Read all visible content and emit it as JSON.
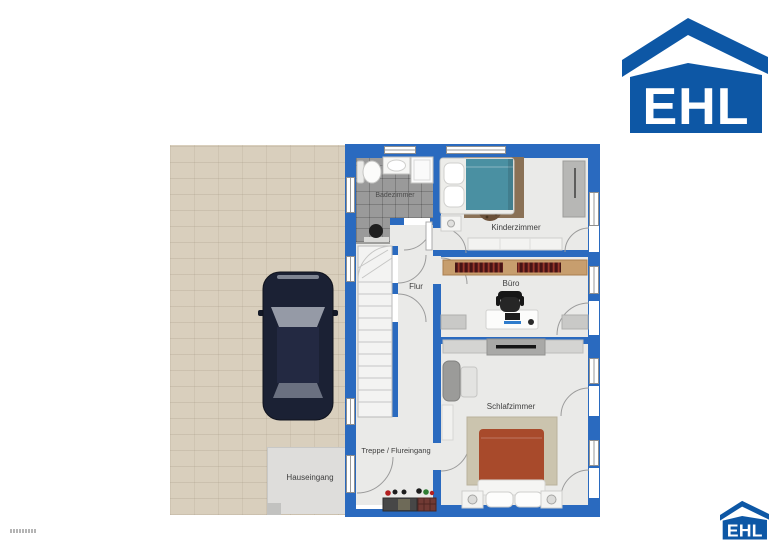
{
  "logo": {
    "text": "EHL"
  },
  "plan": {
    "rooms": {
      "badezimmer": {
        "label": "Badezimmer"
      },
      "kinderzimmer": {
        "label": "Kinderzimmer"
      },
      "flur": {
        "label": "Flur"
      },
      "buero": {
        "label": "Büro"
      },
      "schlafzimmer": {
        "label": "Schlafzimmer"
      },
      "treppe": {
        "label": "Treppe / Flureingang"
      },
      "hauseingang": {
        "label": "Hauseingang"
      }
    }
  },
  "colors": {
    "wall_blue": "#2a6abf",
    "logo_blue": "#0d57a5",
    "driveway_beige": "#d9cfbd",
    "entrance_pad_gray": "#dedddb",
    "bathroom_tile_gray": "#9a9a9a",
    "floor_gray": "#eaeae8",
    "bed_teal": "#4a90a2",
    "bed_red": "#a84a2b",
    "rug_brown": "#8a7156",
    "rug_beige": "#cbc4ae",
    "shelf_wood": "#c79e6e",
    "car_navy": "#1b2134"
  }
}
